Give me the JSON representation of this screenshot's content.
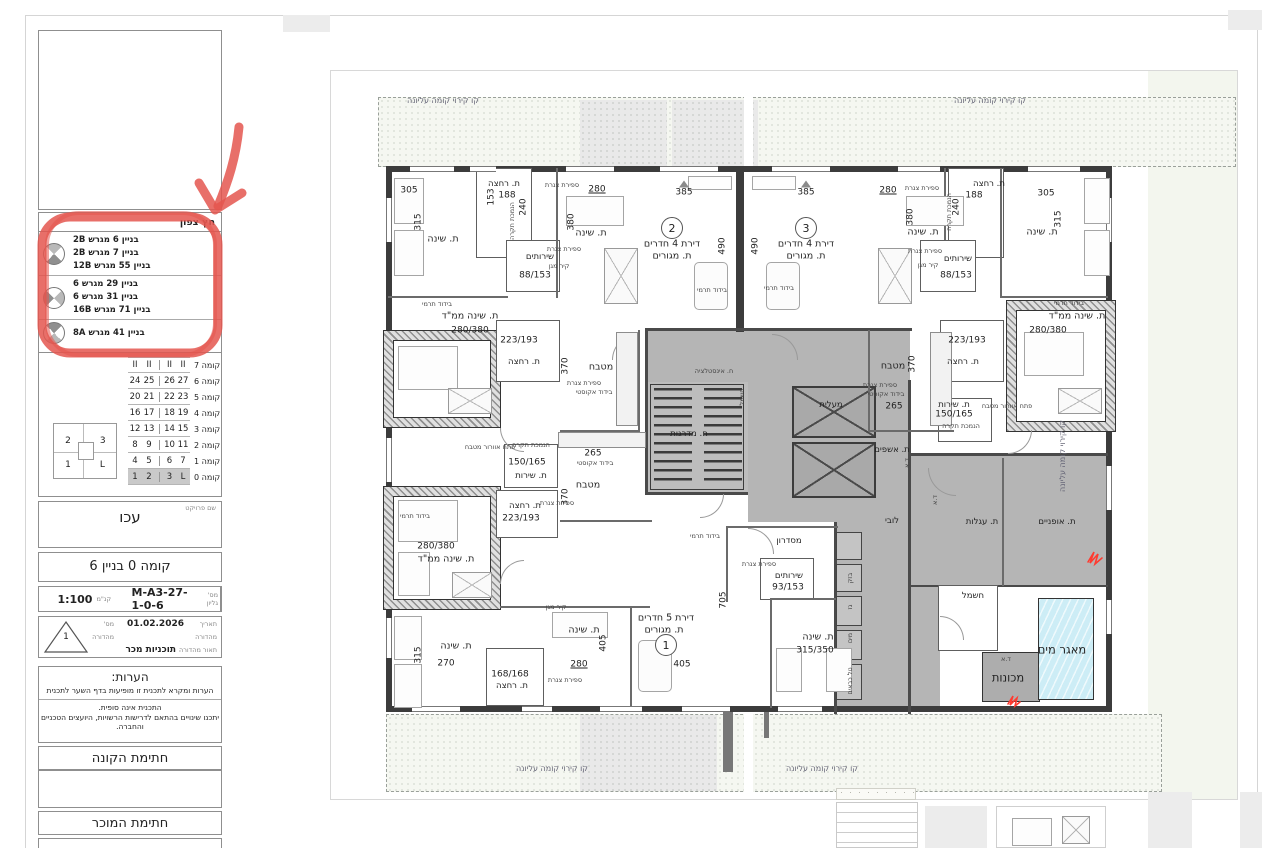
{
  "colors": {
    "annotation_red": "#E4564F",
    "water_blue": "#CDEDF6",
    "core_gray": "#B5B5B5",
    "floor_highlight": "#C9C9C9"
  },
  "sidebar": {
    "north_table": {
      "header": "חץ צפון",
      "groups": [
        {
          "items": [
            "בניין 6 מגרש 2B",
            "בניין 7 מגרש 2B",
            "בניין 55 מגרש 12B"
          ]
        },
        {
          "items": [
            "בניין 29 מגרש 6",
            "בניין 31 מגרש 6",
            "בניין 71 מגרש 16B"
          ]
        },
        {
          "items": [
            "בניין 41 מגרש 8A"
          ]
        }
      ]
    },
    "floor_table": {
      "rows": [
        {
          "label": "קומה 7",
          "cells": [
            "II",
            "II",
            "II",
            "II"
          ],
          "hl": false
        },
        {
          "label": "קומה 6",
          "cells": [
            "24",
            "25",
            "26",
            "27"
          ],
          "hl": false
        },
        {
          "label": "קומה 5",
          "cells": [
            "20",
            "21",
            "22",
            "23"
          ],
          "hl": false
        },
        {
          "label": "קומה 4",
          "cells": [
            "16",
            "17",
            "18",
            "19"
          ],
          "hl": false
        },
        {
          "label": "קומה 3",
          "cells": [
            "12",
            "13",
            "14",
            "15"
          ],
          "hl": false
        },
        {
          "label": "קומה 2",
          "cells": [
            "8",
            "9",
            "10",
            "11"
          ],
          "hl": false
        },
        {
          "label": "קומה 1",
          "cells": [
            "4",
            "5",
            "6",
            "7"
          ],
          "hl": false
        },
        {
          "label": "קומה 0",
          "cells": [
            "1",
            "2",
            "3",
            "L"
          ],
          "hl": true
        }
      ]
    },
    "key_plan": {
      "tl": "2",
      "tr": "3",
      "bl": "1",
      "br": "L"
    },
    "project": {
      "caption": "שם פרויקט",
      "name": "עכו"
    },
    "sheet_title": "קומה 0 בניין 6",
    "meta": {
      "sheet_caption": "מס' גליון",
      "sheet_number": "M-A3-27-1-0-6",
      "scale_caption": "קנ\"מ",
      "scale": "1:100"
    },
    "edition": {
      "date_caption": "תאריך מהדורה",
      "date": "01.02.2026",
      "number_caption": "מס' מהדורה",
      "number": "1",
      "desc_caption": "תאור מהדורה",
      "desc": "תוכניות מכר"
    },
    "notes": {
      "title": "הערות:",
      "line1": "הערות ומקרא לתכנית זו מופיעות בדף השער לתכנית",
      "para": [
        "התכנית אינה סופית.",
        "יתכנו שינויים בהתאם לדרישות הרשויות, היועצים הטכניים",
        "והחברה."
      ]
    },
    "signatures": {
      "buyer": "חתימת הקונה",
      "seller": "חתימת המוכר"
    }
  },
  "plan": {
    "apartment_circles": [
      {
        "n": "2",
        "x": 672,
        "y": 228
      },
      {
        "n": "3",
        "x": 806,
        "y": 228
      },
      {
        "n": "1",
        "x": 666,
        "y": 645
      }
    ],
    "labels": [
      {
        "t": "קו קירוי קומה עליונה",
        "x": 443,
        "y": 101,
        "c": "band"
      },
      {
        "t": "קו קירוי קומה עליונה",
        "x": 990,
        "y": 101,
        "c": "band"
      },
      {
        "t": "קו קירוי קומה עליונה",
        "x": 552,
        "y": 769,
        "c": "band"
      },
      {
        "t": "קו קירוי קומה עליונה",
        "x": 822,
        "y": 769,
        "c": "band"
      },
      {
        "t": "קו קירוי קומה עליונה",
        "x": 1063,
        "y": 456,
        "c": "bandv"
      },
      {
        "t": "305",
        "x": 409,
        "y": 191,
        "c": "dim"
      },
      {
        "t": "315",
        "x": 419,
        "y": 222,
        "c": "dimv"
      },
      {
        "t": "ת. שינה",
        "x": 443,
        "y": 239,
        "c": "room"
      },
      {
        "t": "ת. רחצה",
        "x": 504,
        "y": 184,
        "c": "rooms"
      },
      {
        "t": "188",
        "x": 507,
        "y": 196,
        "c": "dim"
      },
      {
        "t": "153",
        "x": 492,
        "y": 197,
        "c": "dimv"
      },
      {
        "t": "240",
        "x": 524,
        "y": 207,
        "c": "dimv"
      },
      {
        "t": "הנמכת תקרה",
        "x": 512,
        "y": 221,
        "c": "tinyv"
      },
      {
        "t": "ספירת צנרת",
        "x": 562,
        "y": 185,
        "c": "tiny"
      },
      {
        "t": "280",
        "x": 597,
        "y": 190,
        "c": "dim u"
      },
      {
        "t": "380",
        "x": 572,
        "y": 222,
        "c": "dimv"
      },
      {
        "t": "ת. שינה",
        "x": 591,
        "y": 233,
        "c": "room"
      },
      {
        "t": "שירותים",
        "x": 540,
        "y": 257,
        "c": "rooms"
      },
      {
        "t": "88/153",
        "x": 535,
        "y": 276,
        "c": "dim"
      },
      {
        "t": "קיר מגן",
        "x": 559,
        "y": 266,
        "c": "tiny"
      },
      {
        "t": "ספירת צנרת",
        "x": 564,
        "y": 249,
        "c": "tiny"
      },
      {
        "t": "בידוד תרמי",
        "x": 437,
        "y": 304,
        "c": "tiny"
      },
      {
        "t": "ת. שינה ממ\"ד",
        "x": 470,
        "y": 316,
        "c": "room"
      },
      {
        "t": "280/380",
        "x": 470,
        "y": 331,
        "c": "dim"
      },
      {
        "t": "223/193",
        "x": 519,
        "y": 341,
        "c": "dim"
      },
      {
        "t": "ת. רחצה",
        "x": 524,
        "y": 362,
        "c": "rooms"
      },
      {
        "t": "370",
        "x": 566,
        "y": 366,
        "c": "dimv"
      },
      {
        "t": "מטבח",
        "x": 601,
        "y": 367,
        "c": "room"
      },
      {
        "t": "ספירת צנרת",
        "x": 584,
        "y": 383,
        "c": "tiny"
      },
      {
        "t": "בידוד אקוסטי",
        "x": 594,
        "y": 392,
        "c": "tiny"
      },
      {
        "t": "385",
        "x": 684,
        "y": 193,
        "c": "dim"
      },
      {
        "t": "385",
        "x": 806,
        "y": 193,
        "c": "dim"
      },
      {
        "t": "דירת 4 חדרים",
        "x": 672,
        "y": 244,
        "c": "room"
      },
      {
        "t": "ת. מגורים",
        "x": 672,
        "y": 256,
        "c": "room"
      },
      {
        "t": "דירת 4 חדרים",
        "x": 806,
        "y": 244,
        "c": "room"
      },
      {
        "t": "ת. מגורים",
        "x": 806,
        "y": 256,
        "c": "room"
      },
      {
        "t": "490",
        "x": 723,
        "y": 246,
        "c": "dimv"
      },
      {
        "t": "490",
        "x": 756,
        "y": 246,
        "c": "dimv"
      },
      {
        "t": "בידוד תרמי",
        "x": 712,
        "y": 290,
        "c": "tiny"
      },
      {
        "t": "בידוד תרמי",
        "x": 779,
        "y": 288,
        "c": "tiny"
      },
      {
        "t": "280",
        "x": 888,
        "y": 191,
        "c": "dim u"
      },
      {
        "t": "ספירת צנרת",
        "x": 922,
        "y": 188,
        "c": "tiny"
      },
      {
        "t": "380",
        "x": 911,
        "y": 217,
        "c": "dimv"
      },
      {
        "t": "ת. שינה",
        "x": 923,
        "y": 232,
        "c": "room"
      },
      {
        "t": "ת. רחצה",
        "x": 989,
        "y": 184,
        "c": "rooms"
      },
      {
        "t": "188",
        "x": 974,
        "y": 196,
        "c": "dim"
      },
      {
        "t": "240",
        "x": 957,
        "y": 207,
        "c": "dimv"
      },
      {
        "t": "הנמכת תקרה",
        "x": 949,
        "y": 212,
        "c": "tinyv"
      },
      {
        "t": "305",
        "x": 1046,
        "y": 194,
        "c": "dim"
      },
      {
        "t": "315",
        "x": 1059,
        "y": 219,
        "c": "dimv"
      },
      {
        "t": "ת. שינה",
        "x": 1042,
        "y": 232,
        "c": "room"
      },
      {
        "t": "ספירת צנרת",
        "x": 925,
        "y": 251,
        "c": "tiny"
      },
      {
        "t": "שירותים",
        "x": 958,
        "y": 259,
        "c": "rooms"
      },
      {
        "t": "88/153",
        "x": 956,
        "y": 276,
        "c": "dim"
      },
      {
        "t": "קיר מגן",
        "x": 928,
        "y": 265,
        "c": "tiny"
      },
      {
        "t": "בידוד תרמי",
        "x": 1069,
        "y": 303,
        "c": "tiny"
      },
      {
        "t": "ת. שינה ממ\"ד",
        "x": 1077,
        "y": 316,
        "c": "room"
      },
      {
        "t": "280/380",
        "x": 1048,
        "y": 331,
        "c": "dim"
      },
      {
        "t": "223/193",
        "x": 967,
        "y": 341,
        "c": "dim"
      },
      {
        "t": "ת. רחצה",
        "x": 963,
        "y": 362,
        "c": "rooms"
      },
      {
        "t": "370",
        "x": 913,
        "y": 364,
        "c": "dimv"
      },
      {
        "t": "מטבח",
        "x": 893,
        "y": 366,
        "c": "room"
      },
      {
        "t": "ספירת צנרת",
        "x": 880,
        "y": 385,
        "c": "tiny"
      },
      {
        "t": "בידוד אקוסטי",
        "x": 886,
        "y": 394,
        "c": "tiny"
      },
      {
        "t": "265",
        "x": 894,
        "y": 407,
        "c": "dim"
      },
      {
        "t": "ח. אינסטלציה",
        "x": 714,
        "y": 371,
        "c": "tiny"
      },
      {
        "t": "חשמל",
        "x": 742,
        "y": 397,
        "c": "tinyv"
      },
      {
        "t": "ח. מדרגות",
        "x": 689,
        "y": 434,
        "c": "rooms"
      },
      {
        "t": "מעלית",
        "x": 831,
        "y": 405,
        "c": "rooms"
      },
      {
        "t": "ת. אשפים",
        "x": 892,
        "y": 450,
        "c": "rooms"
      },
      {
        "t": "ד.א",
        "x": 907,
        "y": 463,
        "c": "tinyv"
      },
      {
        "t": "לובי",
        "x": 892,
        "y": 521,
        "c": "rooms"
      },
      {
        "t": "בידוד תרמי",
        "x": 705,
        "y": 536,
        "c": "tiny"
      },
      {
        "t": "מסדרון",
        "x": 789,
        "y": 541,
        "c": "rooms"
      },
      {
        "t": "ספירת צנרת",
        "x": 759,
        "y": 564,
        "c": "tiny"
      },
      {
        "t": "שירותים",
        "x": 789,
        "y": 576,
        "c": "rooms"
      },
      {
        "t": "93/153",
        "x": 788,
        "y": 588,
        "c": "dim"
      },
      {
        "t": "705",
        "x": 724,
        "y": 600,
        "c": "dimv"
      },
      {
        "t": "פתח אוורור מטבח",
        "x": 490,
        "y": 447,
        "c": "tiny"
      },
      {
        "t": "הנמכת תקרה",
        "x": 531,
        "y": 445,
        "c": "tiny"
      },
      {
        "t": "150/165",
        "x": 527,
        "y": 463,
        "c": "dim"
      },
      {
        "t": "ת. שירות",
        "x": 531,
        "y": 476,
        "c": "rooms"
      },
      {
        "t": "265",
        "x": 593,
        "y": 454,
        "c": "dim"
      },
      {
        "t": "בידוד אקוסטי",
        "x": 595,
        "y": 463,
        "c": "tiny"
      },
      {
        "t": "מטבח",
        "x": 588,
        "y": 485,
        "c": "room"
      },
      {
        "t": "370",
        "x": 566,
        "y": 497,
        "c": "dimv"
      },
      {
        "t": "ספירת צנרת",
        "x": 557,
        "y": 503,
        "c": "tiny"
      },
      {
        "t": "ת. רחצה",
        "x": 525,
        "y": 506,
        "c": "rooms"
      },
      {
        "t": "223/193",
        "x": 521,
        "y": 519,
        "c": "dim"
      },
      {
        "t": "בידוד תרמי",
        "x": 415,
        "y": 516,
        "c": "tiny"
      },
      {
        "t": "280/380",
        "x": 436,
        "y": 547,
        "c": "dim"
      },
      {
        "t": "ת. שינה ממ\"ד",
        "x": 446,
        "y": 559,
        "c": "room"
      },
      {
        "t": "קיר מגן",
        "x": 556,
        "y": 607,
        "c": "tiny"
      },
      {
        "t": "ת. שינה",
        "x": 584,
        "y": 630,
        "c": "room"
      },
      {
        "t": "405",
        "x": 604,
        "y": 643,
        "c": "dimv"
      },
      {
        "t": "ת. שינה",
        "x": 456,
        "y": 646,
        "c": "room"
      },
      {
        "t": "315",
        "x": 419,
        "y": 655,
        "c": "dimv"
      },
      {
        "t": "270",
        "x": 446,
        "y": 664,
        "c": "dim"
      },
      {
        "t": "168/168",
        "x": 510,
        "y": 675,
        "c": "dim"
      },
      {
        "t": "ת. רחצה",
        "x": 512,
        "y": 686,
        "c": "rooms"
      },
      {
        "t": "280",
        "x": 579,
        "y": 665,
        "c": "dim u"
      },
      {
        "t": "ספירת צנרת",
        "x": 565,
        "y": 680,
        "c": "tiny"
      },
      {
        "t": "דירת 5 חדרים",
        "x": 666,
        "y": 618,
        "c": "room"
      },
      {
        "t": "ת. מגורים",
        "x": 664,
        "y": 630,
        "c": "room"
      },
      {
        "t": "405",
        "x": 682,
        "y": 665,
        "c": "dim"
      },
      {
        "t": "ת. שינה",
        "x": 818,
        "y": 637,
        "c": "room"
      },
      {
        "t": "315/350",
        "x": 815,
        "y": 651,
        "c": "dim"
      },
      {
        "t": "ת. שירות",
        "x": 954,
        "y": 405,
        "c": "rooms"
      },
      {
        "t": "150/165",
        "x": 954,
        "y": 415,
        "c": "dim"
      },
      {
        "t": "הנמכת תקרה",
        "x": 961,
        "y": 426,
        "c": "tiny"
      },
      {
        "t": "פתח אוורור מטבח",
        "x": 1007,
        "y": 406,
        "c": "tiny"
      },
      {
        "t": "ד.א",
        "x": 935,
        "y": 500,
        "c": "tinyv"
      },
      {
        "t": "ת. עגלות",
        "x": 982,
        "y": 522,
        "c": "rooms"
      },
      {
        "t": "ת. אופניים",
        "x": 1057,
        "y": 522,
        "c": "rooms"
      },
      {
        "t": "חשמל",
        "x": 973,
        "y": 596,
        "c": "rooms"
      },
      {
        "t": "מאגר מים",
        "x": 1062,
        "y": 650,
        "c": "room big"
      },
      {
        "t": "מכונות",
        "x": 1008,
        "y": 678,
        "c": "room big"
      },
      {
        "t": "ד.א",
        "x": 1006,
        "y": 659,
        "c": "tiny"
      },
      {
        "t": "בזק",
        "x": 850,
        "y": 578,
        "c": "tinyv"
      },
      {
        "t": "גז",
        "x": 850,
        "y": 607,
        "c": "tinyv"
      },
      {
        "t": "מים",
        "x": 850,
        "y": 638,
        "c": "tinyv"
      },
      {
        "t": "טל כבאים",
        "x": 850,
        "y": 681,
        "c": "tinyv"
      }
    ]
  }
}
